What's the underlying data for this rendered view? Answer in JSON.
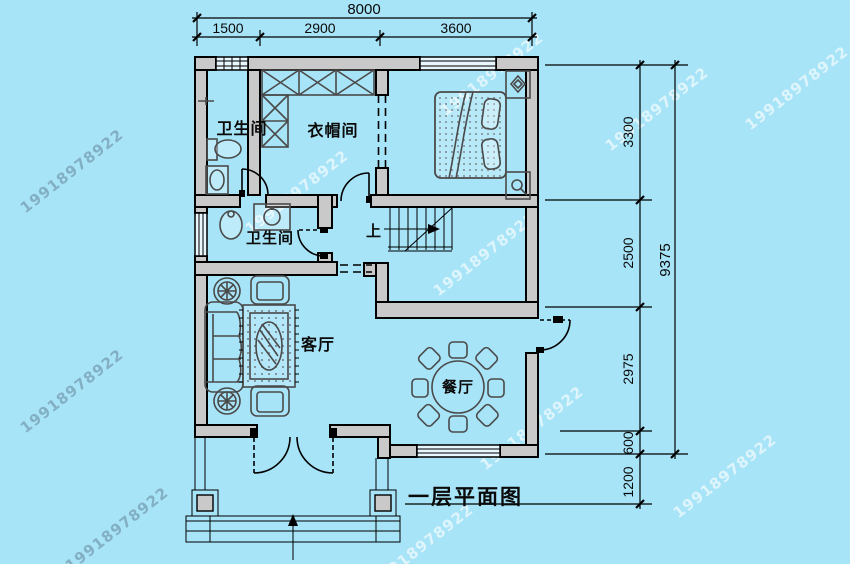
{
  "caption": {
    "title": "一层平面图"
  },
  "watermark": {
    "text": "19918978922"
  },
  "rooms": {
    "bathroom_top": "卫生间",
    "cloakroom": "衣帽间",
    "bathroom_mid": "卫生间",
    "living": "客厅",
    "dining": "餐厅",
    "stair_up": "上"
  },
  "dimensions": {
    "top": {
      "total": "8000",
      "segments": [
        "1500",
        "2900",
        "3600"
      ]
    },
    "right": {
      "total": "9375",
      "segments": [
        "3300",
        "2500",
        "2975",
        "600",
        "1200"
      ]
    }
  },
  "colors": {
    "background": "#a8e4f8",
    "wall_fill": "#c9c9c9",
    "line": "#000000"
  }
}
